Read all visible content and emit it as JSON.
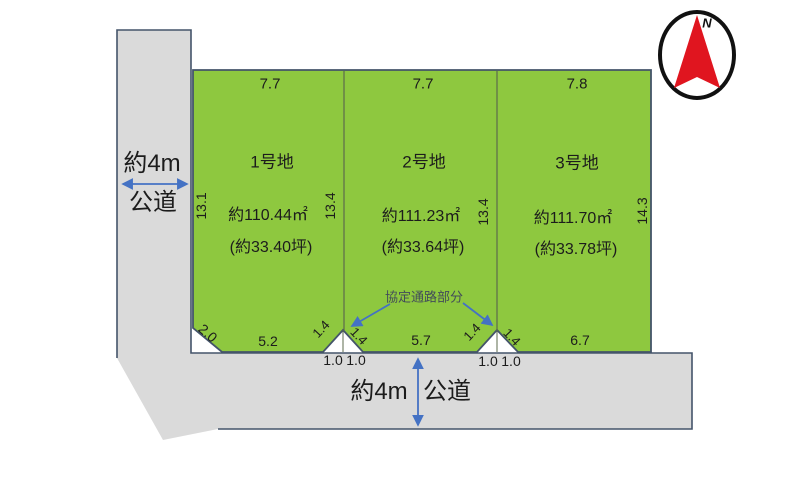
{
  "diagram": {
    "compass": {
      "north": "N"
    },
    "roads": {
      "left": {
        "width": "約4m",
        "kind": "公道"
      },
      "bottom": {
        "width": "約4m",
        "kind": "公道"
      }
    },
    "passage_label": "協定通路部分",
    "plots": [
      {
        "name": "1号地",
        "area_m2": "約110.44㎡",
        "area_tsubo": "(約33.40坪)",
        "top": "7.7",
        "side_left": "13.1",
        "side_right": "13.4",
        "frontage": "5.2"
      },
      {
        "name": "2号地",
        "area_m2": "約111.23㎡",
        "area_tsubo": "(約33.64坪)",
        "top": "7.7",
        "side_right": "13.4",
        "frontage": "5.7"
      },
      {
        "name": "3号地",
        "area_m2": "約111.70㎡",
        "area_tsubo": "(約33.78坪)",
        "top": "7.8",
        "side_right": "14.3",
        "frontage": "6.7"
      }
    ],
    "corner_cut": "2.0",
    "notch1": {
      "side_l": "1.4",
      "side_r": "1.4",
      "base_l": "1.0",
      "base_r": "1.0"
    },
    "notch2": {
      "side_l": "1.4",
      "side_r": "1.4",
      "base_l": "1.0",
      "base_r": "1.0"
    },
    "colors": {
      "green": "#8ec83f",
      "road": "#dadada",
      "border": "#44546a",
      "arrow": "#4472c4",
      "red": "#e0151f",
      "ink": "#1c1c1c",
      "passage": "#424c59",
      "divider": "#5d6b4c"
    }
  }
}
